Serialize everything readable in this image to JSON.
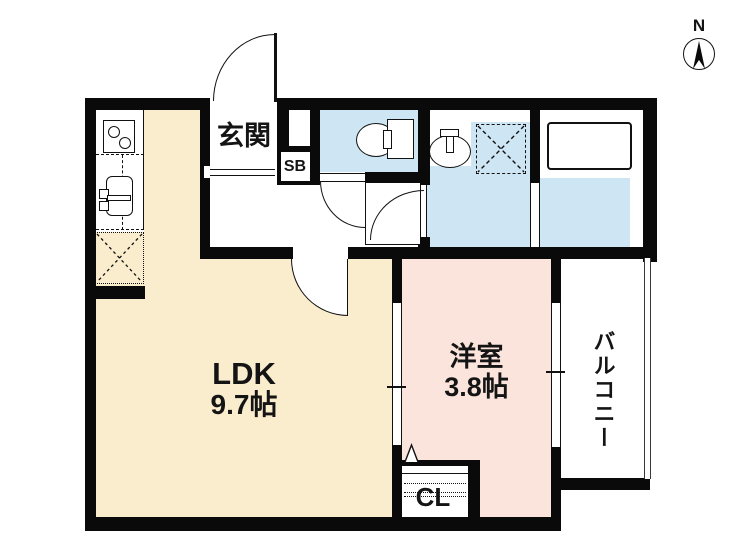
{
  "plan": {
    "title": "1LDK floor plan",
    "rooms": {
      "ldk": {
        "label": "LDK",
        "size": "9.7帖"
      },
      "western": {
        "label": "洋室",
        "size": "3.8帖"
      },
      "genkan": {
        "label": "玄関"
      },
      "shoebox": {
        "label": "SB"
      },
      "closet": {
        "label": "CL"
      },
      "balcony": {
        "label": "バルコニー"
      }
    },
    "compass": {
      "north": "N"
    },
    "fixtures": [
      "stove-icon",
      "kitchen-sink-icon",
      "refrigerator-space-icon",
      "toilet-icon",
      "washbasin-icon",
      "washing-machine-space-icon",
      "bathtub-icon",
      "compass-icon"
    ]
  },
  "colors": {
    "ldk-fill": "#FAEDCD",
    "western-fill": "#FAE4DC",
    "wet-fill": "#CEE5F4",
    "wall": "#0A0A0A"
  }
}
